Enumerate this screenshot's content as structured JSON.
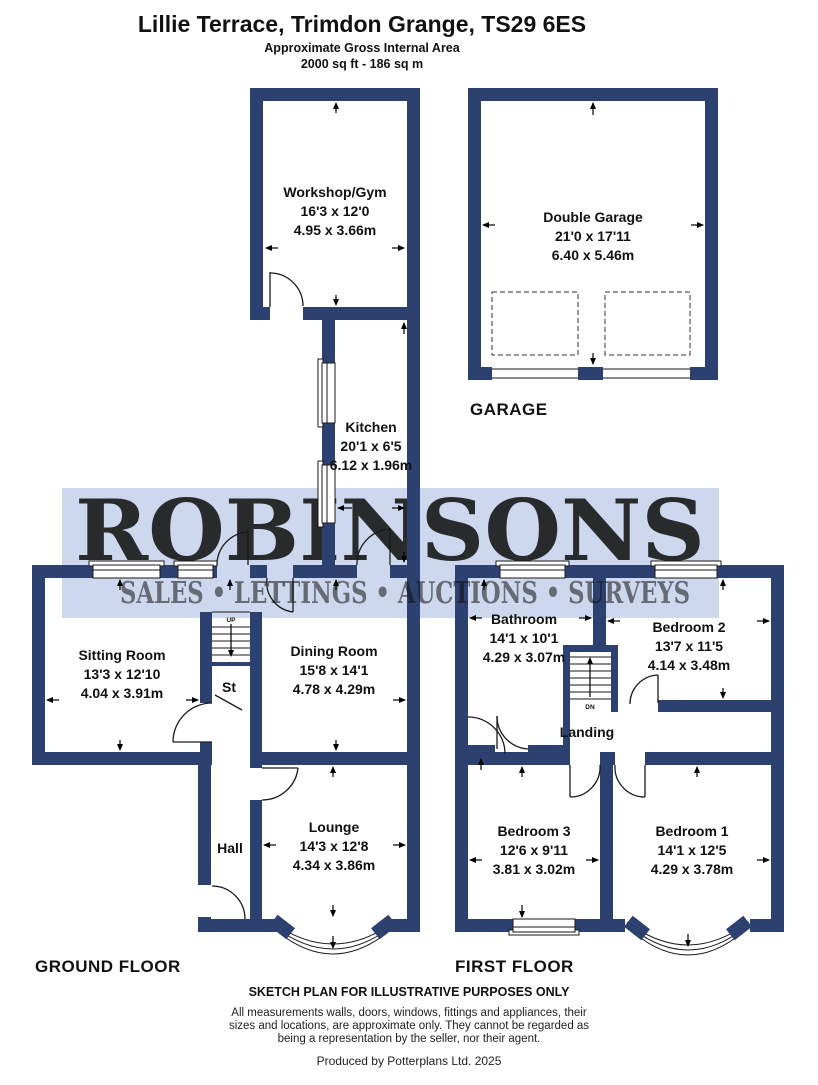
{
  "header": {
    "title": "Lillie Terrace, Trimdon Grange, TS29 6ES",
    "area_label": "Approximate Gross Internal Area",
    "area_value": "2000 sq ft - 186 sq m"
  },
  "watermark": {
    "brand": "ROBINSONS",
    "tagline": "SALES • LETTINGS • AUCTIONS • SURVEYS"
  },
  "floor_labels": {
    "garage": "GARAGE",
    "ground": "GROUND FLOOR",
    "first": "FIRST FLOOR"
  },
  "rooms": {
    "workshop": {
      "name": "Workshop/Gym",
      "imperial": "16'3 x 12'0",
      "metric": "4.95 x 3.66m"
    },
    "garage": {
      "name": "Double Garage",
      "imperial": "21'0 x 17'11",
      "metric": "6.40 x 5.46m"
    },
    "kitchen": {
      "name": "Kitchen",
      "imperial": "20'1 x 6'5",
      "metric": "6.12 x 1.96m"
    },
    "sitting": {
      "name": "Sitting Room",
      "imperial": "13'3 x 12'10",
      "metric": "4.04 x 3.91m"
    },
    "dining": {
      "name": "Dining Room",
      "imperial": "15'8 x 14'1",
      "metric": "4.78 x 4.29m"
    },
    "st": {
      "name": "St"
    },
    "hall": {
      "name": "Hall"
    },
    "lounge": {
      "name": "Lounge",
      "imperial": "14'3 x 12'8",
      "metric": "4.34 x 3.86m"
    },
    "bathroom": {
      "name": "Bathroom",
      "imperial": "14'1 x 10'1",
      "metric": "4.29 x 3.07m"
    },
    "bedroom2": {
      "name": "Bedroom 2",
      "imperial": "13'7 x 11'5",
      "metric": "4.14 x 3.48m"
    },
    "landing": {
      "name": "Landing"
    },
    "bedroom3": {
      "name": "Bedroom 3",
      "imperial": "12'6 x 9'11",
      "metric": "3.81 x 3.02m"
    },
    "bedroom1": {
      "name": "Bedroom 1",
      "imperial": "14'1 x 12'5",
      "metric": "4.29 x 3.78m"
    }
  },
  "stairs": {
    "up": "UP",
    "down": "DN"
  },
  "footer": {
    "disclaimer_title": "SKETCH PLAN FOR ILLUSTRATIVE PURPOSES ONLY",
    "disclaimer_line1": "All measurements walls, doors, windows, fittings and appliances, their",
    "disclaimer_line2": "sizes and locations, are approximate only. They cannot be regarded as",
    "disclaimer_line3": "being a representation by the seller, nor their agent.",
    "produced_by": "Produced by Potterplans Ltd. 2025"
  },
  "colors": {
    "wall": "#2d4170",
    "watermark_bg": "#cdd8ee",
    "watermark_text": "#ffffff",
    "line": "#1a1a1a"
  }
}
